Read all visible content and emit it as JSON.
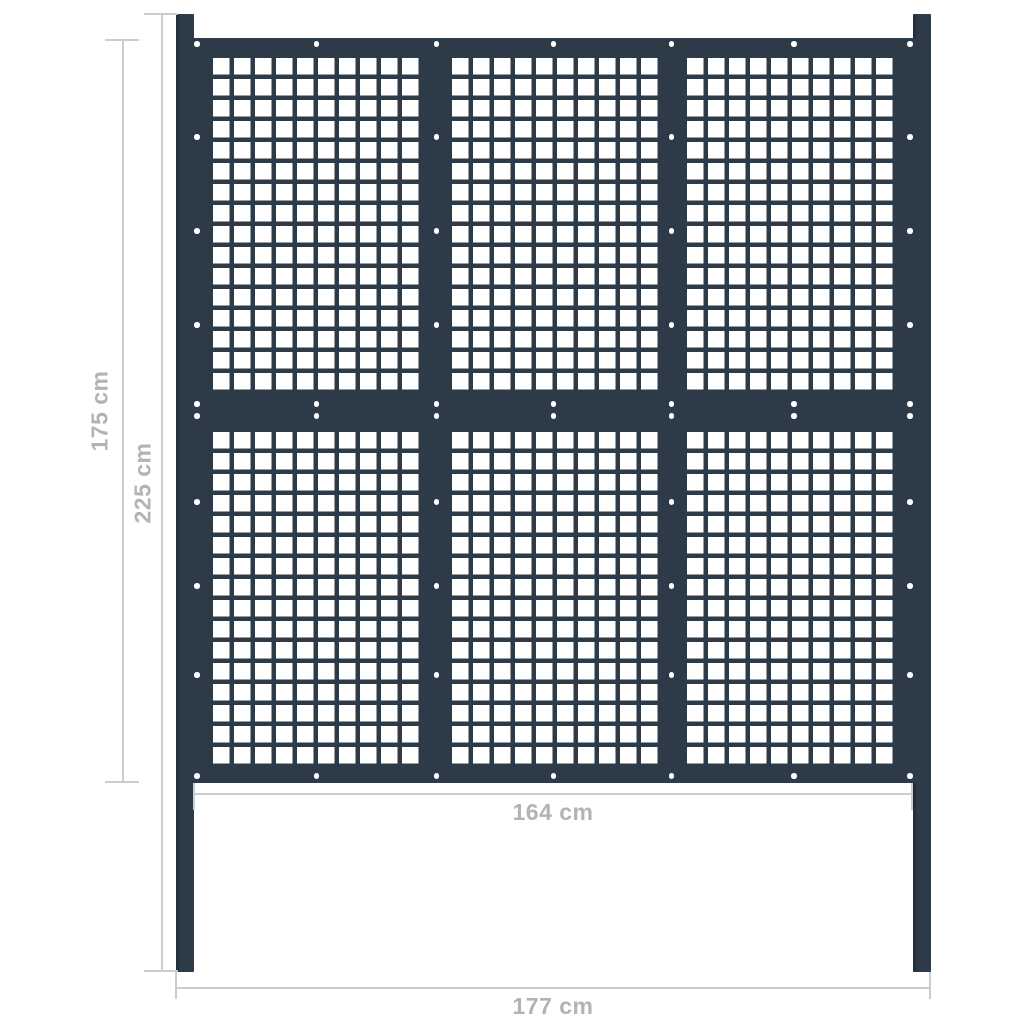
{
  "diagram": {
    "type": "fence-panel-dimension-drawing",
    "labels": {
      "panel_height": "175 cm",
      "total_height": "225 cm",
      "panel_width": "164 cm",
      "total_width": "177 cm"
    },
    "colors": {
      "anthracite": "#2d3b49",
      "anthracite_dark": "#22303d",
      "background": "#ffffff",
      "dim_line": "#cbcccc",
      "dim_text": "#b3b3b3",
      "screw": "#ffffff"
    },
    "fence": {
      "posts": 2,
      "section_grid": {
        "columns": 3,
        "rows": 2
      },
      "holes_per_section": {
        "columns": 10,
        "rows": 16
      },
      "screw_count": 52
    }
  }
}
